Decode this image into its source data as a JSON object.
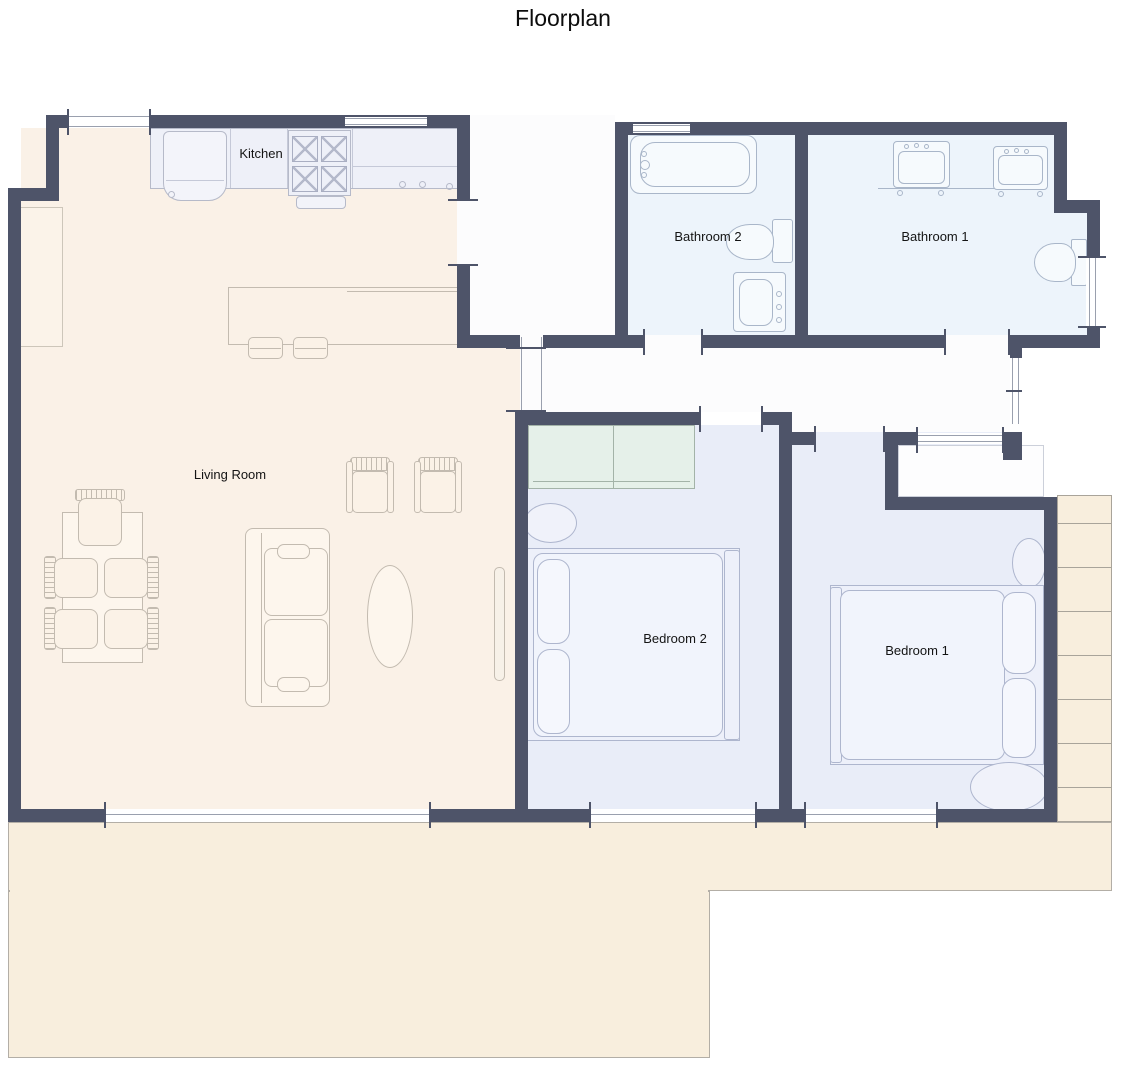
{
  "title": "Floorplan",
  "rooms": {
    "kitchen": "Kitchen",
    "living_room": "Living Room",
    "bathroom2": "Bathroom 2",
    "bathroom1": "Bathroom 1",
    "bedroom2": "Bedroom 2",
    "bedroom1": "Bedroom 1"
  },
  "colors": {
    "wall": "#4e5469",
    "living_floor": "#faf1e7",
    "patio_floor": "#f8eedd",
    "bathroom_floor": "#edf4fb",
    "bedroom_floor": "#e9edf8",
    "hallway_floor": "#fcfcfd",
    "wardrobe": "#e5f0e9",
    "counter": "#eef0f8"
  }
}
